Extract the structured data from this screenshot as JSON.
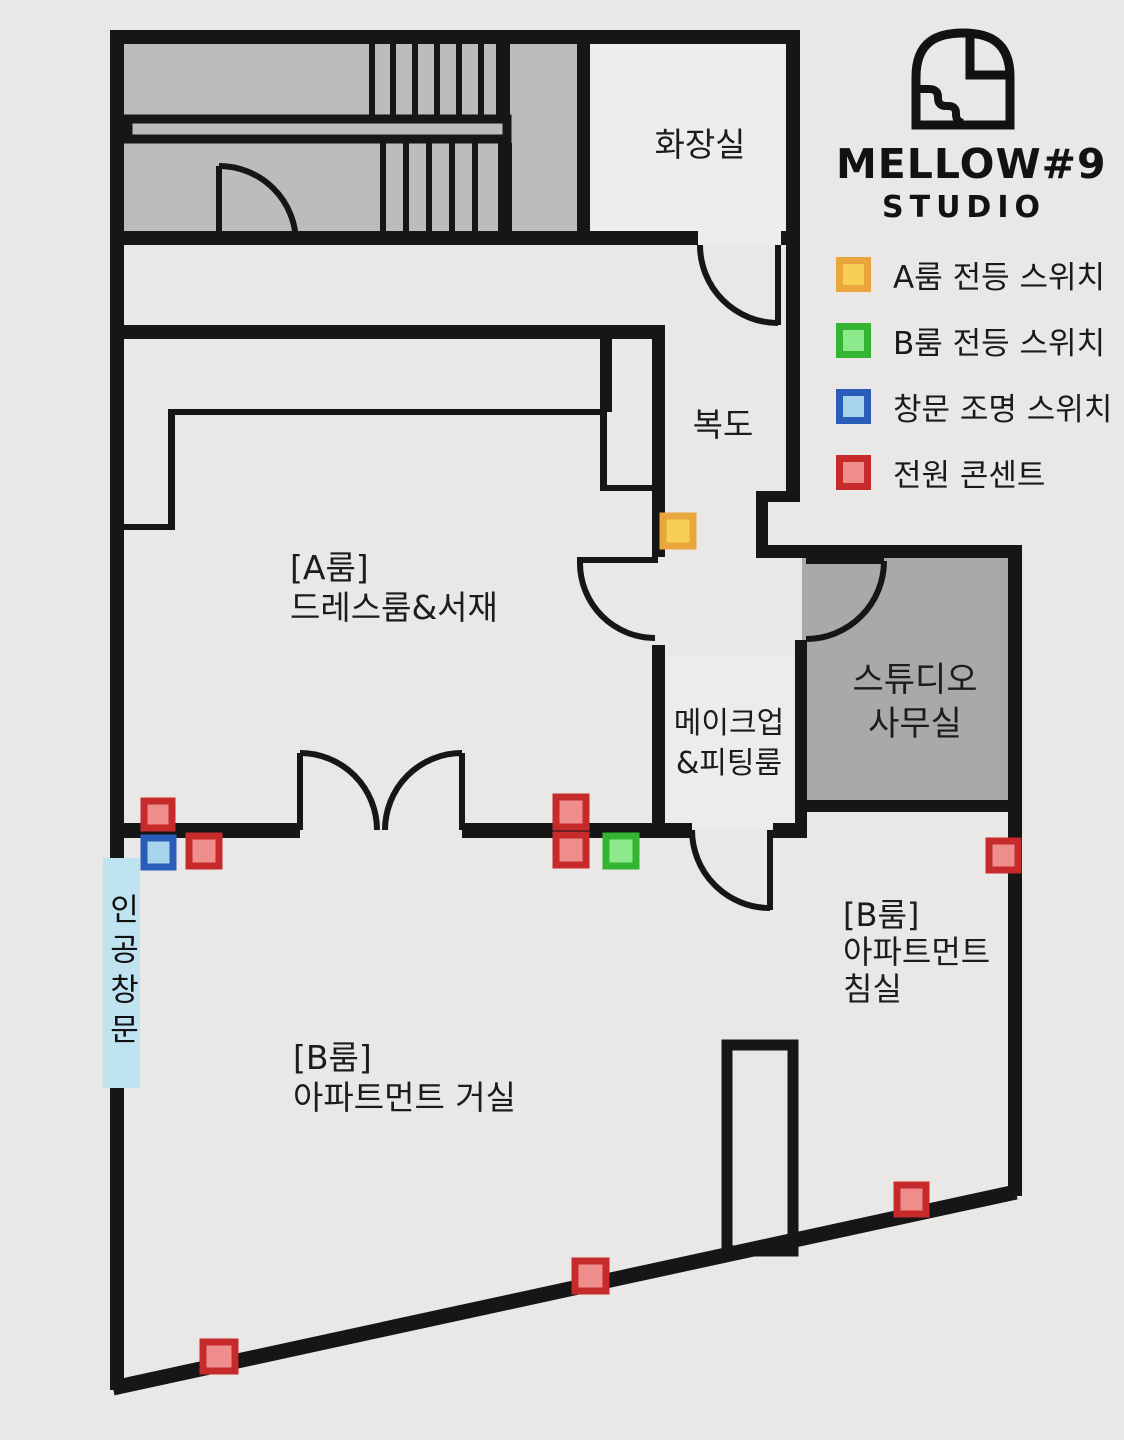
{
  "brand": {
    "name": "MELLOW#9",
    "subtitle": "STUDIO"
  },
  "legend": {
    "items": [
      {
        "id": "a-room-light-switch",
        "label": "A룸 전등 스위치",
        "fill": "#f7cf55",
        "border": "#e8a63c"
      },
      {
        "id": "b-room-light-switch",
        "label": "B룸 전등 스위치",
        "fill": "#8ce98c",
        "border": "#33b533"
      },
      {
        "id": "window-light-switch",
        "label": "창문 조명 스위치",
        "fill": "#a8d4ec",
        "border": "#2a5db8"
      },
      {
        "id": "power-outlet",
        "label": "전원 콘센트",
        "fill": "#ef8c8c",
        "border": "#c62a2a"
      }
    ]
  },
  "rooms": {
    "bathroom": {
      "label": "화장실"
    },
    "corridor": {
      "label": "복도"
    },
    "a_room": {
      "label": "[A룸]\n드레스룸&서재"
    },
    "makeup": {
      "label": "메이크업\n&피팅룸"
    },
    "office": {
      "label": "스튜디오\n사무실"
    },
    "b_bedroom": {
      "label": "[B룸]\n아파트먼트\n침실"
    },
    "b_living": {
      "label": "[B룸]\n아파트먼트 거실"
    },
    "artificial_window": {
      "label": "인공창문"
    }
  },
  "markers": {
    "power_outlets": 8,
    "a_room_switches": 1,
    "b_room_switches": 1,
    "window_switches": 1
  },
  "colors": {
    "wall": "#161616",
    "background": "#e9e8e7",
    "stairwell": "#bcbcbc",
    "office": "#a9a9a9",
    "window_strip": "#bfe3f0"
  }
}
